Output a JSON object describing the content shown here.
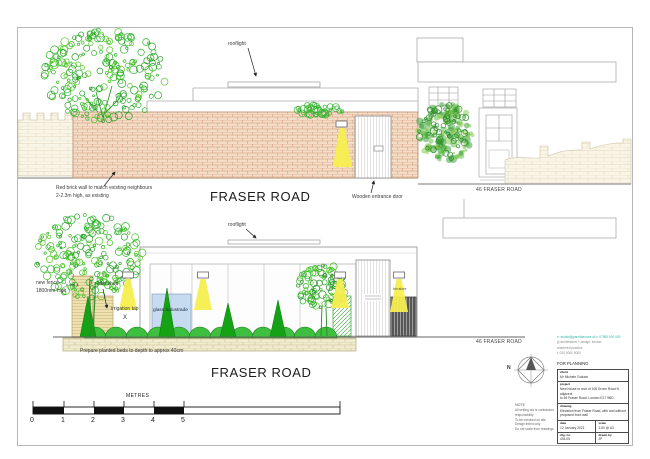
{
  "sheet": {
    "top_elevation": {
      "rooflight": "rooflight",
      "brick_note_1": "Red brick wall to match existing neighbours",
      "brick_note_2": "2-2.3m high, as existing",
      "road": "FRASER ROAD",
      "door_note": "Wooden entrance door",
      "neighbour": "46 FRASER ROAD"
    },
    "lower_elevation": {
      "rooflight": "rooflight",
      "fence_note_1": "new fence",
      "fence_note_2": "1800mm high",
      "bike_shed": "bike shed",
      "irrigation": "irrigation tap",
      "irrigation_mark": "X",
      "balustrade": "glass balustrade",
      "bin_store": "bin store",
      "bed_note": "Prepare planted beds to depth to approx 40cm",
      "road": "FRASER ROAD",
      "neighbour": "46 FRASER ROAD"
    },
    "scale_bar": {
      "title": "METRES",
      "labels": [
        "0",
        "1",
        "2",
        "3",
        "4",
        "5",
        "10"
      ]
    },
    "compass": {
      "north": "N"
    },
    "note": {
      "title": "NOTE",
      "lines": [
        "All setting out is contractors",
        "responsibility",
        "To be checked on site",
        "Design intent only",
        "Do not scale from drawings"
      ]
    },
    "title_block": {
      "contact_teal": "e: studio@jparchitecture.uk  t: 07950 000 000",
      "contact_1": "jp architecture + design, london",
      "contact_2": "chartered practice",
      "contact_3": "t: 020 0000 0000",
      "status": "FOR PLANNING",
      "client_label": "client",
      "client": "Mr Michele Godwin",
      "project_label": "project",
      "project_1": "New house to rear of 108 Grove Road N adjacent",
      "project_2": "to 46 Fraser Road, London E17 9BD",
      "drawing_label": "drawing",
      "drawing_1": "Elevation from Fraser Road, with and without",
      "drawing_2": "proposed front wall",
      "date_label": "date",
      "date": "12 January 2021",
      "scale_label": "scale",
      "scale": "1:50 @ A3",
      "drg_label": "drg. no.",
      "drg": "404.05",
      "drawn_label": "drawn by",
      "drawn": "JP"
    },
    "colors": {
      "brick": "#f4dcc6",
      "brick_line": "#cf9878",
      "light_yellow": "#f6ee4f",
      "foliage": "#2db52d",
      "balustrade_blue": "#b9d2ee",
      "teal_text": "#2fb3a6"
    }
  }
}
